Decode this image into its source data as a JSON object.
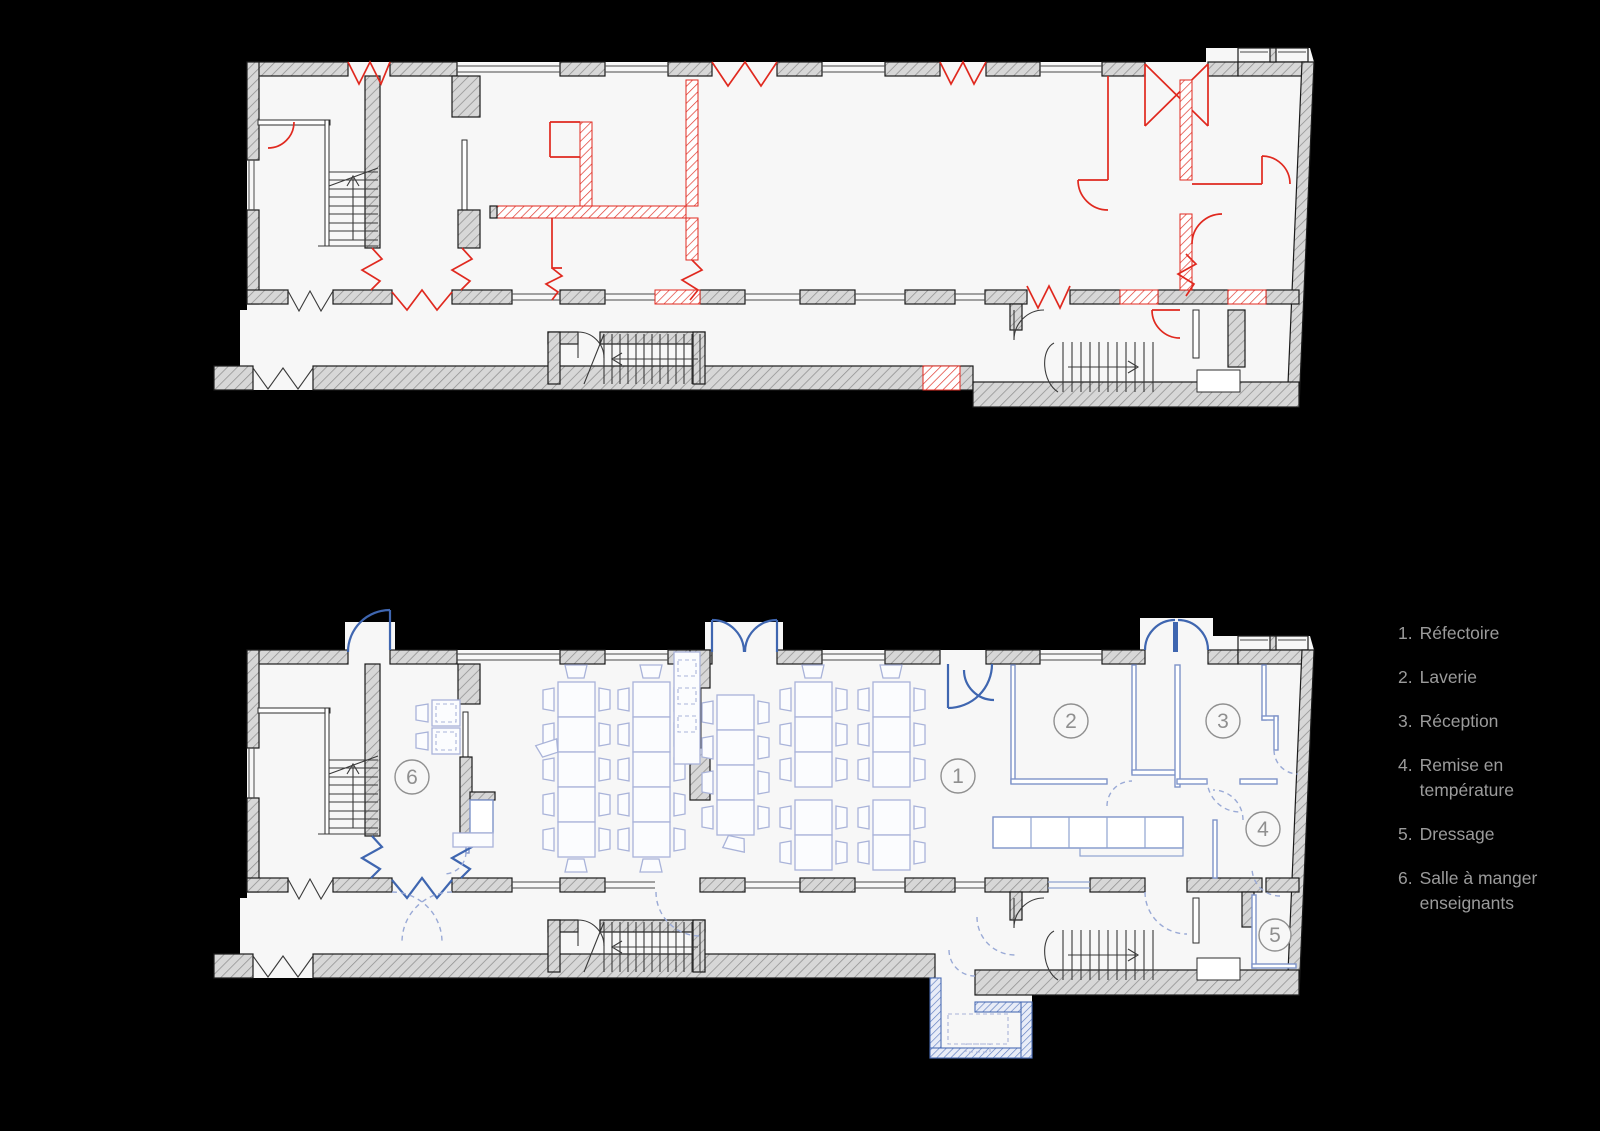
{
  "canvas": {
    "background": "#000000",
    "paper": "#f7f7f7"
  },
  "colors": {
    "wall_gray": "#d7d7d7",
    "wall_outline": "#1b1b1b",
    "demolition_red": "#e0291f",
    "new_work_blue": "#3f66b0",
    "partition_blue": "#7e93c9",
    "furniture_blue": "#a9b3d9",
    "marker_gray": "#8f8f8f",
    "legend_text_gray": "#9b9b9b"
  },
  "plans": {
    "top": {
      "name": "existing state with demolition (red)"
    },
    "bottom": {
      "name": "project state with new work (blue)"
    }
  },
  "rooms": [
    {
      "number": "1",
      "label": "Réfectoire"
    },
    {
      "number": "2",
      "label": "Laverie"
    },
    {
      "number": "3",
      "label": "Réception"
    },
    {
      "number": "4",
      "label": "Remise en température"
    },
    {
      "number": "5",
      "label": "Dressage"
    },
    {
      "number": "6",
      "label": "Salle à manger enseignants"
    }
  ],
  "legend": {
    "items": [
      {
        "num": "1.",
        "text": "Réfectoire"
      },
      {
        "num": "2.",
        "text": "Laverie"
      },
      {
        "num": "3.",
        "text": "Réception"
      },
      {
        "num": "4.",
        "text": "Remise en température"
      },
      {
        "num": "5.",
        "text": "Dressage"
      },
      {
        "num": "6.",
        "text": "Salle à manger enseignants"
      }
    ]
  }
}
